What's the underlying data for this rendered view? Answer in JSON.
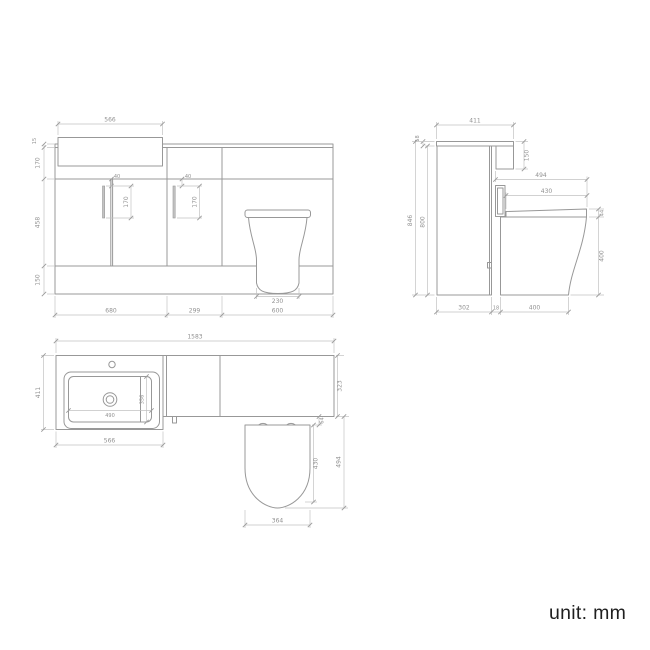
{
  "meta": {
    "unit_label": "unit: mm"
  },
  "front": {
    "label": "front elevation",
    "dims": {
      "basin_width": "566",
      "worktop_thickness": "15",
      "basin_zone_height": "170",
      "door_height": "458",
      "plinth_height": "150",
      "left_handle_offset": "40",
      "left_handle_length": "170",
      "mid_handle_offset": "40",
      "mid_handle_length": "170",
      "pan_base_width": "230",
      "vanity_unit_width": "680",
      "mid_unit_width": "299",
      "wc_unit_width": "600"
    }
  },
  "side": {
    "label": "side elevation",
    "dims": {
      "worktop_depth": "411",
      "worktop_thickness": "18",
      "fascia_drop": "150",
      "overall_height": "846",
      "cabinet_height": "800",
      "pan_projection": "494",
      "seat_depth": "430",
      "seat_thickness": "44",
      "pan_height": "400",
      "cabinet_depth": "302",
      "gap": "18",
      "pan_depth": "400"
    }
  },
  "plan": {
    "label": "plan view",
    "dims": {
      "overall_width": "1583",
      "basin_unit_depth": "411",
      "bowl_width": "490",
      "bowl_depth": "356",
      "basin_width": "566",
      "worktop_depth": "323",
      "seat_setback": "64",
      "seat_depth": "430",
      "pan_projection": "494",
      "seat_width": "364"
    }
  }
}
